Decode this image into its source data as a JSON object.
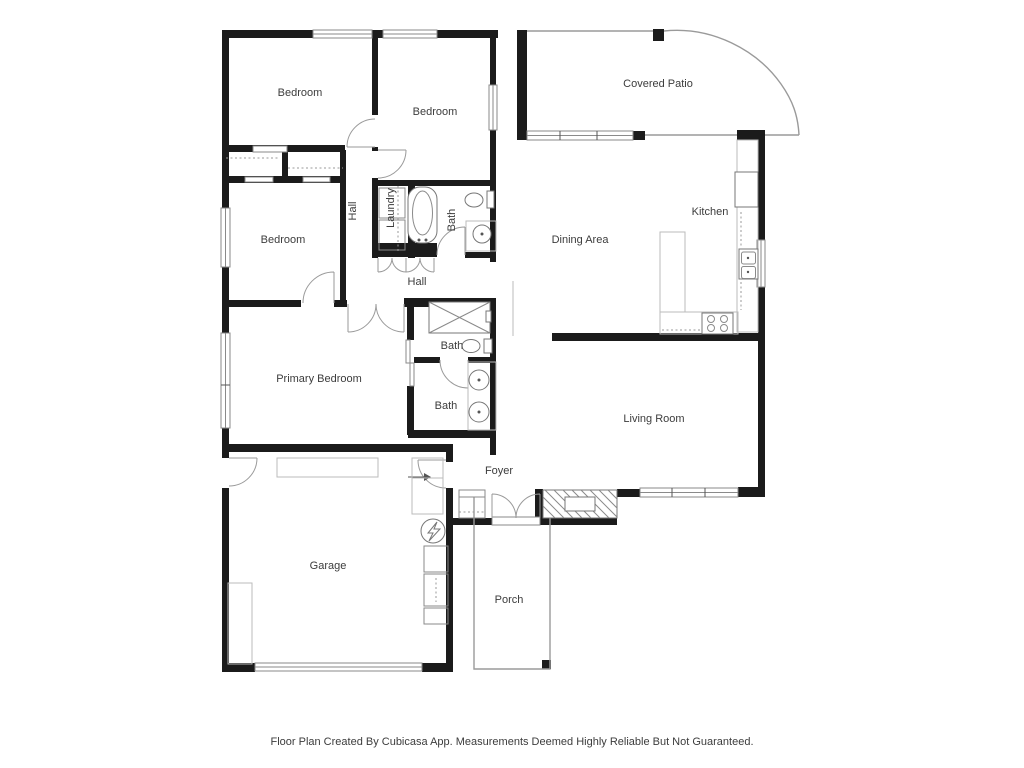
{
  "floor_plan": {
    "rooms": [
      {
        "id": "bedroom-top-left",
        "label": "Bedroom"
      },
      {
        "id": "bedroom-top-middle",
        "label": "Bedroom"
      },
      {
        "id": "covered-patio",
        "label": "Covered Patio"
      },
      {
        "id": "bedroom-left",
        "label": "Bedroom"
      },
      {
        "id": "hall-upper",
        "label": "Hall"
      },
      {
        "id": "laundry",
        "label": "Laundry"
      },
      {
        "id": "bath-upper",
        "label": "Bath"
      },
      {
        "id": "kitchen",
        "label": "Kitchen"
      },
      {
        "id": "dining-area",
        "label": "Dining Area"
      },
      {
        "id": "hall-lower",
        "label": "Hall"
      },
      {
        "id": "bath-middle",
        "label": "Bath"
      },
      {
        "id": "primary-bedroom",
        "label": "Primary Bedroom"
      },
      {
        "id": "bath-lower",
        "label": "Bath"
      },
      {
        "id": "living-room",
        "label": "Living Room"
      },
      {
        "id": "foyer",
        "label": "Foyer"
      },
      {
        "id": "garage",
        "label": "Garage"
      },
      {
        "id": "porch",
        "label": "Porch"
      }
    ],
    "fixtures": [
      "bathtub",
      "toilet",
      "round-sink",
      "double-vanity-sinks",
      "shower",
      "stove-4-burner",
      "refrigerator",
      "kitchen-double-sink",
      "water-heater",
      "washer-dryer",
      "fireplace",
      "closet-rods",
      "workbench",
      "entry-direction-arrow"
    ],
    "colors": {
      "walls": "#1b1b1b",
      "labels": "#3c3c3c",
      "fixtures": "#8a8a8a",
      "background": "#ffffff"
    },
    "footer": "Floor Plan Created By Cubicasa App. Measurements Deemed Highly Reliable But Not Guaranteed."
  }
}
